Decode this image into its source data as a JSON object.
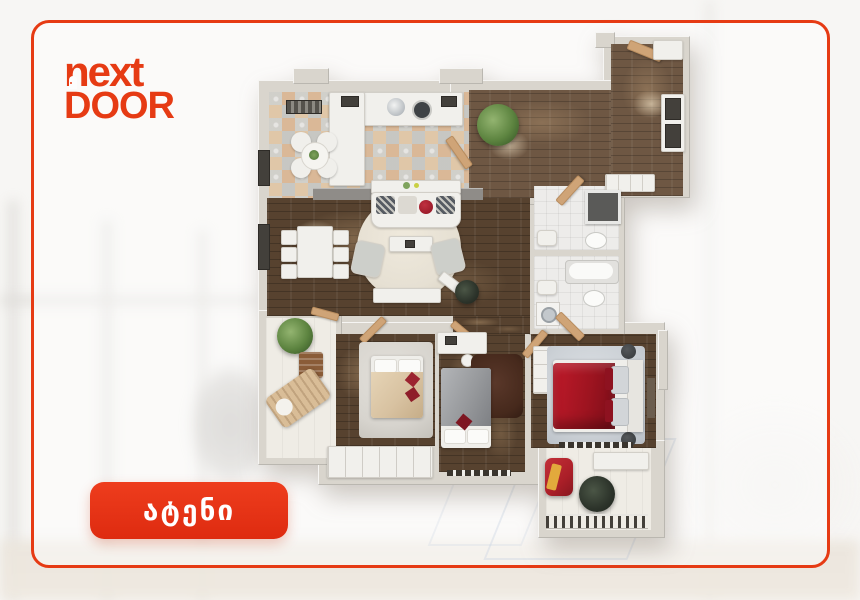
{
  "brand": {
    "line1": "next",
    "line2": "DOOR"
  },
  "badge": {
    "label": "ატენი"
  },
  "theme": {
    "brand-red": "#e63b14",
    "badge-red": "#de2b10",
    "wall": "#d9d5cd",
    "wood": "#57422f",
    "wood-light": "#6e5743",
    "tile-base": "#e7e0d2",
    "bath-floor": "#edecea",
    "rug-cream": "#e6e0d3",
    "rug-gray": "#d7d4ce",
    "rug-blue": "#ccd1d6",
    "rug-dark": "#46291c",
    "bed-beige": "#d8c2a1",
    "bed-gray": "#97999c",
    "bed-red": "#9e1420",
    "chair-red": "#ab1f28",
    "accent-yellow": "#e2a93c",
    "plant-green": "#5d8440",
    "plant-dark": "#2c332a",
    "door-tan": "#cfa477",
    "white-furniture": "#f1f0ec"
  }
}
